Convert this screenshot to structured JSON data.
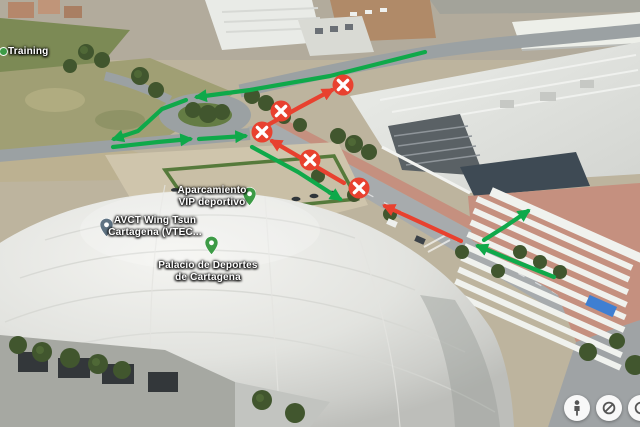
{
  "view": {
    "app_context": "3D satellite map view with traffic-routing annotations",
    "place": "Palacio de Deportes de Cartagena"
  },
  "colors": {
    "route_green": "#0fa94a",
    "route_red": "#e8412f",
    "marker_red": "#e8412f",
    "marker_x": "#ffffff",
    "label_text": "#ffffff",
    "pin_green": "#3d9b46",
    "pin_grey": "#5f7383",
    "poi_dot_green": "#3d9b46",
    "control_icon": "#565656"
  },
  "map_labels": [
    {
      "id": "training",
      "lines": [
        "Training"
      ],
      "x": 8,
      "y": 46,
      "align": "left",
      "icon": {
        "type": "poi-dot-green",
        "x": 3,
        "y": 51
      }
    },
    {
      "id": "aparcamiento-vip",
      "lines": [
        "Aparcamiento",
        "VIP deportivo"
      ],
      "x": 212,
      "y": 185,
      "align": "center",
      "pin": {
        "type": "green",
        "x": 249,
        "y": 206
      }
    },
    {
      "id": "avct-wing-tsun",
      "lines": [
        "AVCT Wing Tsun",
        "Cartagena (VTEC..."
      ],
      "x": 155,
      "y": 215,
      "align": "center",
      "pin": {
        "type": "grey",
        "x": 106,
        "y": 237
      }
    },
    {
      "id": "palacio-deportes",
      "lines": [
        "Palacio de Deportes",
        "de Cartagena"
      ],
      "x": 208,
      "y": 260,
      "align": "center",
      "pin": {
        "type": "green",
        "x": 211,
        "y": 255
      }
    }
  ],
  "routes": [
    {
      "id": "green-top-westbound",
      "color": "green",
      "points": [
        [
          425,
          52
        ],
        [
          330,
          76
        ],
        [
          250,
          90
        ],
        [
          197,
          97
        ]
      ]
    },
    {
      "id": "green-roundabout-west-exit",
      "color": "green",
      "points": [
        [
          186,
          100
        ],
        [
          162,
          109
        ],
        [
          149,
          121
        ],
        [
          138,
          131
        ],
        [
          114,
          139
        ]
      ]
    },
    {
      "id": "green-lower-eastbound-1",
      "color": "green",
      "points": [
        [
          113,
          147
        ],
        [
          158,
          142
        ],
        [
          190,
          139
        ]
      ]
    },
    {
      "id": "green-lower-eastbound-2",
      "color": "green",
      "points": [
        [
          199,
          139
        ],
        [
          245,
          136
        ]
      ]
    },
    {
      "id": "green-avenue-southeast",
      "color": "green",
      "points": [
        [
          252,
          147
        ],
        [
          298,
          172
        ],
        [
          340,
          199
        ]
      ]
    },
    {
      "id": "green-avenue-northwest",
      "color": "green",
      "points": [
        [
          554,
          277
        ],
        [
          514,
          261
        ],
        [
          478,
          246
        ]
      ]
    },
    {
      "id": "green-market-entry",
      "color": "green",
      "points": [
        [
          484,
          240
        ],
        [
          506,
          226
        ],
        [
          528,
          211
        ]
      ]
    },
    {
      "id": "red-diagonal-northeast",
      "color": "red",
      "points": [
        [
          266,
          126
        ],
        [
          300,
          107
        ],
        [
          332,
          90
        ]
      ]
    },
    {
      "id": "red-avenue-northwest",
      "color": "red",
      "points": [
        [
          344,
          183
        ],
        [
          308,
          162
        ],
        [
          272,
          141
        ]
      ]
    },
    {
      "id": "red-lower-northwest",
      "color": "red",
      "points": [
        [
          461,
          241
        ],
        [
          422,
          223
        ],
        [
          385,
          206
        ]
      ]
    }
  ],
  "no_entry_markers": [
    [
      343,
      85
    ],
    [
      281,
      111
    ],
    [
      262,
      132
    ],
    [
      310,
      160
    ],
    [
      359,
      188
    ]
  ],
  "controls": [
    {
      "id": "pegman",
      "icon": "pegman-icon"
    },
    {
      "id": "compass",
      "icon": "compass-icon"
    },
    {
      "id": "partial",
      "icon": "partial-icon"
    }
  ]
}
